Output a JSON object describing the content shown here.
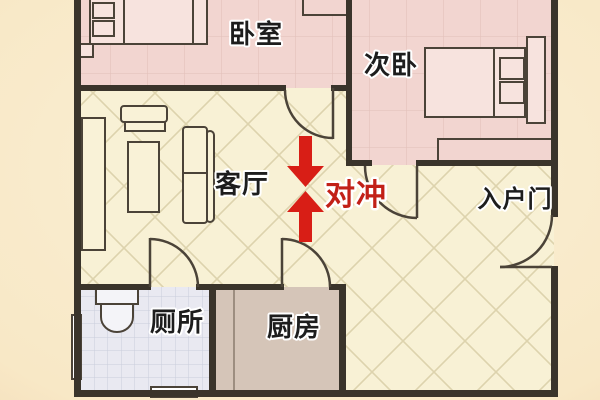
{
  "figure": {
    "type": "apartment-floor-plan",
    "theme": "feng-shui door clash illustration"
  },
  "rooms": [
    {
      "id": "master-bedroom",
      "label": "卧室"
    },
    {
      "id": "second-bedroom",
      "label": "次卧"
    },
    {
      "id": "living-room",
      "label": "客厅"
    },
    {
      "id": "toilet",
      "label": "厕所"
    },
    {
      "id": "kitchen",
      "label": "厨房"
    }
  ],
  "annotations": {
    "clash_label": "对冲",
    "entry_door_label": "入户门"
  },
  "colors": {
    "wall": "#3a342b",
    "bedroom_fill": "#f2d5d0",
    "living_fill": "#f8f1d5",
    "toilet_fill": "#e9e9f1",
    "kitchen_fill": "#d5c5b8",
    "furniture_fill": "#f9f2d7",
    "bed_fill": "#f7e3de",
    "fixture_fill": "#f4f4f8",
    "arrow_red": "#d81e16",
    "clash_text": "#c22017",
    "label_text": "#1d1d1d"
  }
}
